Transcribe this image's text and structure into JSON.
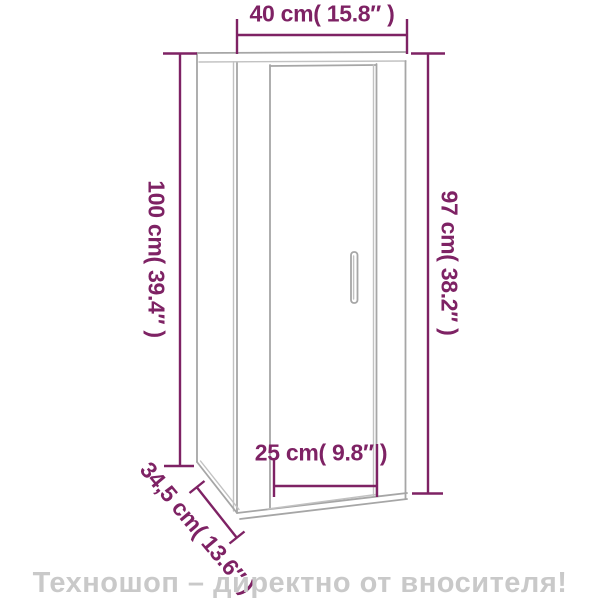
{
  "diagram": {
    "dimensions": {
      "width": "40 cm( 15.8″ )",
      "height_left": "100 cm( 39.4″ )",
      "height_right": "97 cm( 38.2″ )",
      "door_width": "25 cm( 9.8″ )",
      "depth": "34,5 cm( 13.6″ )"
    },
    "colors": {
      "dim": "#7e2264",
      "edge": "#a6a6a6",
      "edgelight": "#c2c2c2",
      "watermark": "#c9c9c9",
      "bg": "#ffffff"
    }
  },
  "footer": {
    "watermark": "Техношоп – директно от вносителя!"
  }
}
